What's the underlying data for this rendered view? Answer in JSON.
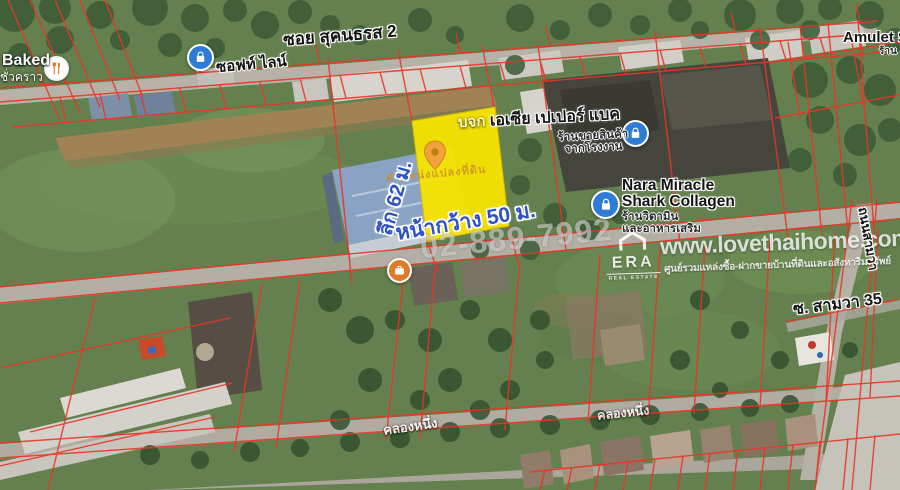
{
  "map": {
    "pois": {
      "soi_top": "ซอย สุคนธรส 2",
      "softline": "ซอฟท์ ไลน์",
      "baked": "Baked",
      "baked_sub": "ชั่วคราว",
      "company_prefix": "บจก",
      "company_name": "เอเซีย เปเปอร์ แบค",
      "company_sub1": "ร้านขายสินค้า",
      "company_sub2": "จากโรงงาน",
      "nara_line1": "Nara Miracle",
      "nara_line2": "Shark Collagen",
      "nara_sub1": "ร้านวิตามิน",
      "nara_sub2": "และอาหารเสริม",
      "amulet": "Amulet S",
      "amulet_sub": "ร้าน",
      "soi_samwa": "ซ. สามวา 35",
      "road_right": "ถนนสามวา",
      "canal_1": "คลองหนึ่ง",
      "canal_2": "คลองหนึ่ง"
    },
    "annotations": {
      "depth": "ลึก 62 ม.",
      "frontage": "หน้ากว้าง 50 ม.",
      "plot_caption": "ตำแหน่งแปลงที่ดิน"
    },
    "watermark": {
      "phone": "02-889-7992",
      "website": "www.lovethaihome.com",
      "tagline": "ศูนย์รวมแหล่งซื้อ-ฝากขายบ้านที่ดินและอสังหาริมทรัพย์",
      "agency": "ERA",
      "agency_sub": "REAL ESTATE"
    },
    "colors": {
      "plot_highlight": "#f7e400",
      "parcel_lines": "#ea3526",
      "dimension_text": "#2d52c8",
      "poi_blue": "#2e7cd6",
      "poi_orange": "#e07b28"
    }
  }
}
